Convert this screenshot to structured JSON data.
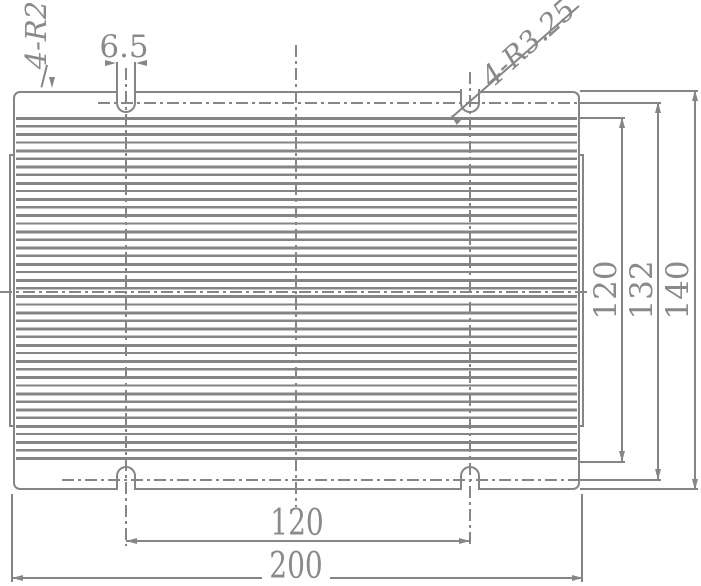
{
  "drawing": {
    "labels": {
      "corner_radius": "4-R2",
      "slot_width": "6.5",
      "slot_radius": "4-R3.25"
    },
    "dimensions": {
      "fin_zone_height": "120",
      "slot_pitch_vertical": "132",
      "overall_height": "140",
      "slot_pitch_horizontal": "120",
      "overall_width": "200"
    },
    "colors": {
      "line": "#858585",
      "text": "#8a8a8a",
      "background": "#ffffff"
    }
  }
}
